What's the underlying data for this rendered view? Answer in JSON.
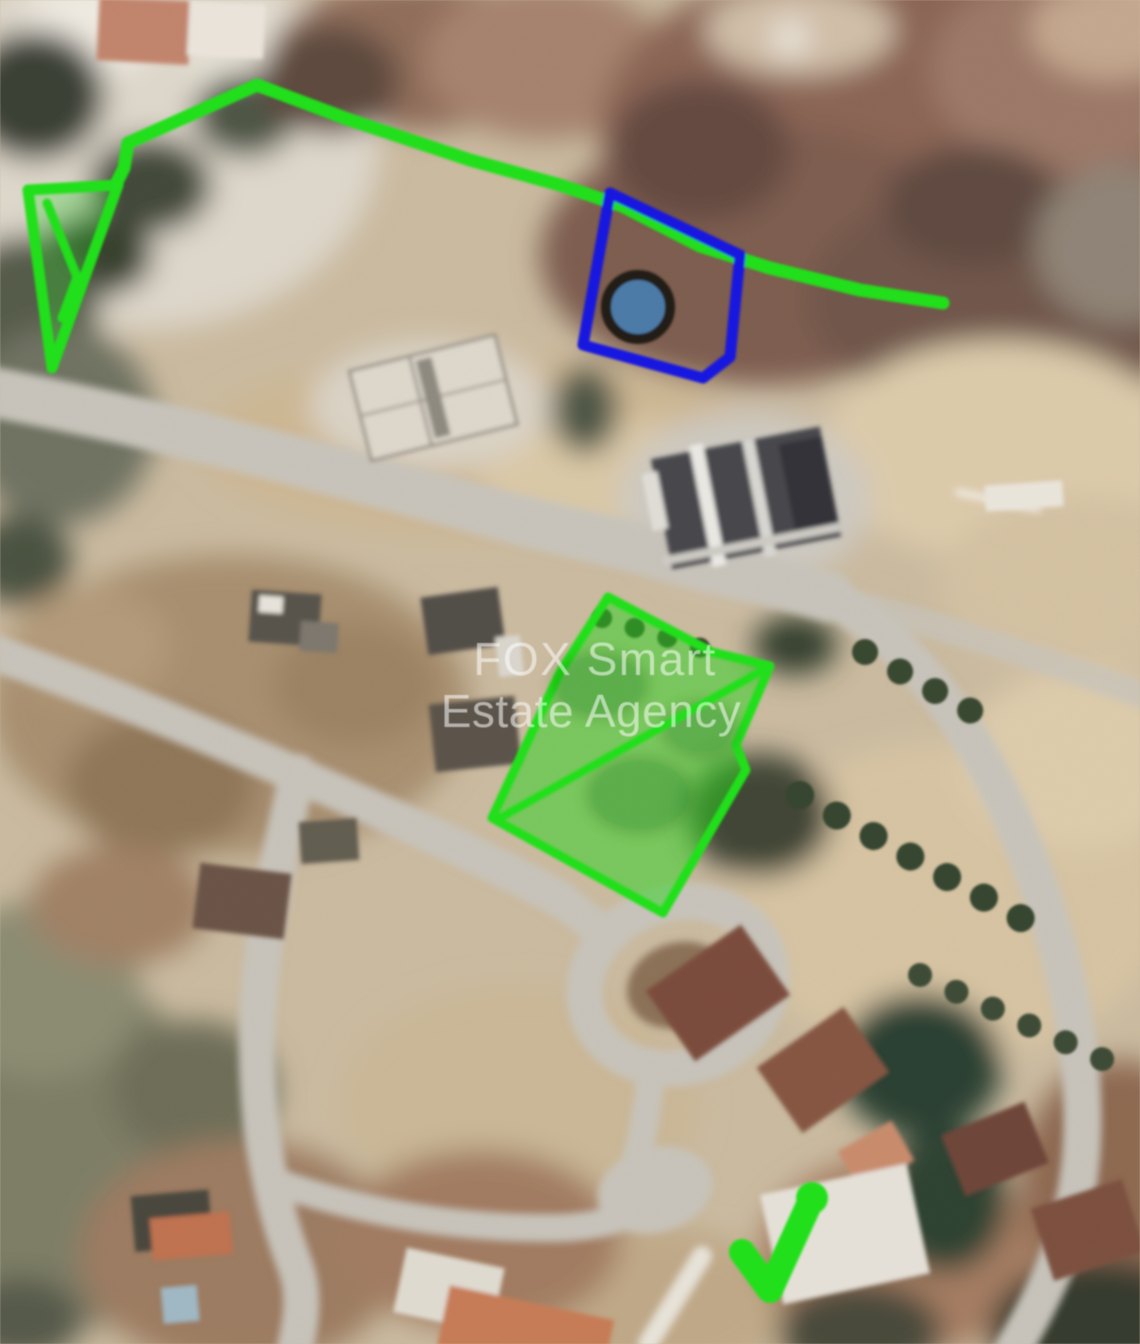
{
  "watermark": {
    "line1": "FOX Smart",
    "line2": "Estate Agency",
    "color": "rgba(255,255,255,0.55)"
  },
  "annotations": {
    "green": "#1ee114",
    "parcel_fill": "rgba(35,214,20,0.5)",
    "triangle_fill": "rgba(35,214,20,0.28)",
    "blue": "#1414e6",
    "marker_fill": "#4a79a7",
    "marker_ring": "#241f19"
  },
  "map": {
    "base": "#c9b99d",
    "road": "#c6c2b9"
  }
}
